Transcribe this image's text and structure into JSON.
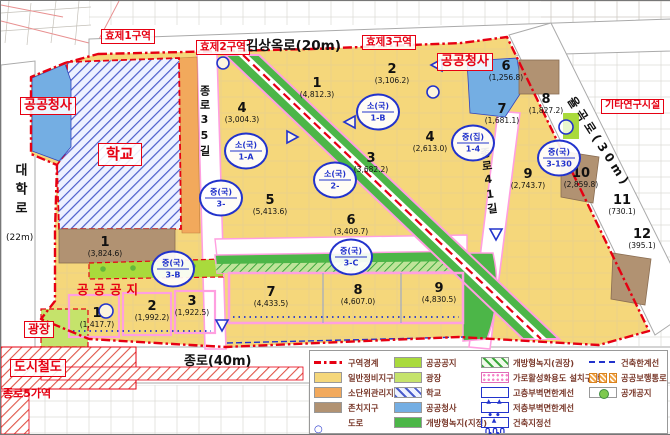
{
  "map": {
    "zones": {
      "zone1": "효제1구역",
      "zone2": "효제2구역",
      "zone3": "효제3구역"
    },
    "roads": {
      "gimsangok": "김상옥로(20m)",
      "jongno": "종로(40m)",
      "daehak": "대학로",
      "daehak_width": "(22m)",
      "jongno35": "종로35길",
      "jongno41": "종로41길",
      "yulgok": "율곡로(30m)"
    },
    "areas": {
      "public_office_left": "공공청사",
      "public_office_right": "공공청사",
      "school": "학교",
      "other_research": "기타연구시설",
      "plaza": "광장",
      "subway": "도시철도",
      "station": "종로5가역",
      "open_space": "공공공지"
    },
    "blocks": [
      {
        "no": "1",
        "area": "(4,812.3)",
        "x": 316,
        "y": 76
      },
      {
        "no": "2",
        "area": "(3,106.2)",
        "x": 391,
        "y": 62
      },
      {
        "no": "4",
        "area": "(3,004.3)",
        "x": 241,
        "y": 101
      },
      {
        "no": "3",
        "area": "(3,682.2)",
        "x": 370,
        "y": 151
      },
      {
        "no": "4",
        "area": "(2,613.0)",
        "x": 429,
        "y": 130
      },
      {
        "no": "5",
        "area": "(5,413.6)",
        "x": 269,
        "y": 193
      },
      {
        "no": "6",
        "area": "(3,409.7)",
        "x": 350,
        "y": 213
      },
      {
        "no": "7",
        "area": "(4,433.5)",
        "x": 270,
        "y": 285
      },
      {
        "no": "8",
        "area": "(4,607.0)",
        "x": 357,
        "y": 283
      },
      {
        "no": "9",
        "area": "(4,830.5)",
        "x": 438,
        "y": 281
      },
      {
        "no": "6",
        "area": "(1,256.8)",
        "x": 505,
        "y": 59
      },
      {
        "no": "7",
        "area": "(1,681.1)",
        "x": 501,
        "y": 102
      },
      {
        "no": "8",
        "area": "(1,827.2)",
        "x": 545,
        "y": 92
      },
      {
        "no": "9",
        "area": "(2,743.7)",
        "x": 527,
        "y": 167
      },
      {
        "no": "10",
        "area": "(2,859.8)",
        "x": 580,
        "y": 166
      },
      {
        "no": "11",
        "area": "(730.1)",
        "x": 621,
        "y": 193
      },
      {
        "no": "12",
        "area": "(395.1)",
        "x": 641,
        "y": 227
      },
      {
        "no": "1",
        "area": "(3,824.6)",
        "x": 104,
        "y": 235
      },
      {
        "no": "1",
        "area": "(1,417.7)",
        "x": 96,
        "y": 306
      },
      {
        "no": "2",
        "area": "(1,992.2)",
        "x": 151,
        "y": 299
      },
      {
        "no": "3",
        "area": "(1,922.5)",
        "x": 191,
        "y": 294
      }
    ],
    "markers": [
      {
        "top": "소(국)",
        "bottom": "1-A",
        "x": 245,
        "y": 150
      },
      {
        "top": "소(국)",
        "bottom": "1-B",
        "x": 377,
        "y": 111
      },
      {
        "top": "소(국)",
        "bottom": "2-",
        "x": 334,
        "y": 179
      },
      {
        "top": "중(국)",
        "bottom": "3-",
        "x": 220,
        "y": 197
      },
      {
        "top": "중(국)",
        "bottom": "3-B",
        "x": 172,
        "y": 268
      },
      {
        "top": "중(국)",
        "bottom": "3-C",
        "x": 350,
        "y": 256
      },
      {
        "top": "중(집)",
        "bottom": "1-4",
        "x": 472,
        "y": 142
      },
      {
        "top": "중(국)",
        "bottom": "3-130",
        "x": 558,
        "y": 157
      }
    ]
  },
  "legend": {
    "columns": [
      {
        "items": [
          {
            "label": "구역경계",
            "swatch": "zone-boundary"
          },
          {
            "label": "일반정비지구",
            "swatch": "general-district"
          },
          {
            "label": "소단위관리지구",
            "swatch": "small-unit-district"
          },
          {
            "label": "존치지구",
            "swatch": "preserve-district"
          },
          {
            "label": "도로",
            "swatch": "road"
          }
        ]
      },
      {
        "items": [
          {
            "label": "공공공지",
            "swatch": "public-open-land"
          },
          {
            "label": "광장",
            "swatch": "plaza"
          },
          {
            "label": "학교",
            "swatch": "school"
          },
          {
            "label": "공공청사",
            "swatch": "public-office"
          },
          {
            "label": "개방형녹지(지정)",
            "swatch": "open-green-designated"
          }
        ]
      },
      {
        "items": [
          {
            "label": "개방형녹지(권장)",
            "swatch": "open-green-recommended"
          },
          {
            "label": "가로활성화용도 설치구간",
            "swatch": "street-activation"
          },
          {
            "label": "고층부벽면한계선",
            "swatch": "upper-wall-limit"
          },
          {
            "label": "저층부벽면한계선",
            "swatch": "lower-wall-limit"
          },
          {
            "label": "건축지정선",
            "swatch": "building-designation-line"
          }
        ]
      },
      {
        "items": [
          {
            "label": "건축한계선",
            "swatch": "building-limit-line"
          },
          {
            "label": "공공보행통로",
            "swatch": "public-walkway"
          },
          {
            "label": "공개공지",
            "swatch": "public-open-space"
          }
        ]
      }
    ]
  }
}
